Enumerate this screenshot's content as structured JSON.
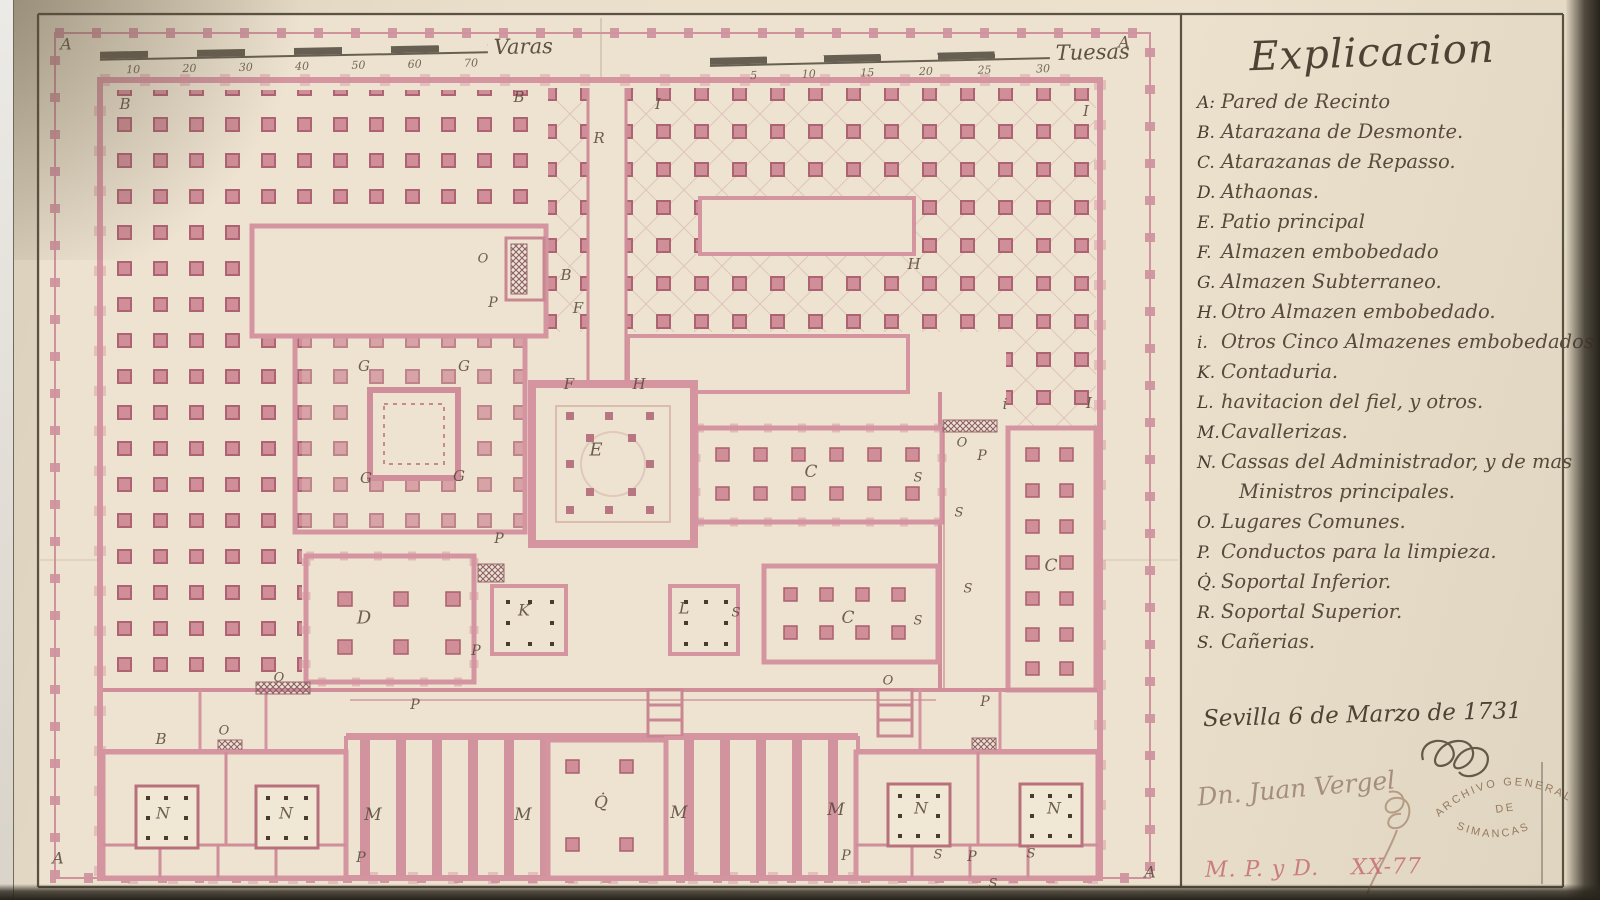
{
  "document": {
    "title": "Explicacion",
    "legend": [
      {
        "k": "A:",
        "t": "Pared de Recinto"
      },
      {
        "k": "B.",
        "t": "Atarazana de Desmonte."
      },
      {
        "k": "C.",
        "t": "Atarazanas de Repasso."
      },
      {
        "k": "D.",
        "t": "Athaonas."
      },
      {
        "k": "E.",
        "t": "Patio principal"
      },
      {
        "k": "F.",
        "t": "Almazen embobedado"
      },
      {
        "k": "G.",
        "t": "Almazen Subterraneo."
      },
      {
        "k": "H.",
        "t": "Otro Almazen embobedado."
      },
      {
        "k": "i.",
        "t": "Otros Cinco Almazenes embobedados"
      },
      {
        "k": "K.",
        "t": "Contaduria."
      },
      {
        "k": "L.",
        "t": "havitacion del fiel, y otros."
      },
      {
        "k": "M.",
        "t": "Cavallerizas."
      },
      {
        "k": "N.",
        "t": "Cassas del Administrador, y de mas",
        "t2": "Ministros principales."
      },
      {
        "k": "O.",
        "t": "Lugares Comunes."
      },
      {
        "k": "P.",
        "t": "Conductos para la limpieza."
      },
      {
        "k": "Q̇.",
        "t": "Soportal Inferior."
      },
      {
        "k": "R.",
        "t": "Soportal Superior."
      },
      {
        "k": "S.",
        "t": "Cañerias."
      }
    ],
    "date_line": "Sevilla 6 de Marzo de 1731",
    "signature": "Dn. Juan Vergel",
    "stamp": {
      "line1": "ARCHIVO GENERAL",
      "line2": "DE",
      "line3": "SIMANCAS"
    },
    "reference": "M. P. y D.    XX-77"
  },
  "scales": {
    "varas": {
      "label": "Varas",
      "ticks": [
        "10",
        "20",
        "30",
        "40",
        "50",
        "60",
        "70"
      ]
    },
    "tuesas": {
      "label": "Tuesas",
      "ticks": [
        "5",
        "10",
        "15",
        "20",
        "25",
        "30"
      ]
    }
  },
  "plan": {
    "labels": [
      {
        "t": "A",
        "x": 66,
        "y": 44,
        "s": 16
      },
      {
        "t": "A",
        "x": 1124,
        "y": 42,
        "s": 16
      },
      {
        "t": "A",
        "x": 58,
        "y": 858,
        "s": 16
      },
      {
        "t": "A",
        "x": 1150,
        "y": 872,
        "s": 16
      },
      {
        "t": "B",
        "x": 125,
        "y": 104
      },
      {
        "t": "B",
        "x": 519,
        "y": 97
      },
      {
        "t": "B",
        "x": 566,
        "y": 275
      },
      {
        "t": "B",
        "x": 161,
        "y": 739
      },
      {
        "t": "R",
        "x": 599,
        "y": 138
      },
      {
        "t": "I",
        "x": 658,
        "y": 104
      },
      {
        "t": "I",
        "x": 1086,
        "y": 111
      },
      {
        "t": "i",
        "x": 1005,
        "y": 404
      },
      {
        "t": "I",
        "x": 1089,
        "y": 403
      },
      {
        "t": "H",
        "x": 914,
        "y": 264
      },
      {
        "t": "H",
        "x": 639,
        "y": 384
      },
      {
        "t": "F",
        "x": 578,
        "y": 308
      },
      {
        "t": "F",
        "x": 569,
        "y": 384
      },
      {
        "t": "G",
        "x": 364,
        "y": 366
      },
      {
        "t": "G",
        "x": 464,
        "y": 366
      },
      {
        "t": "G",
        "x": 366,
        "y": 478
      },
      {
        "t": "G",
        "x": 459,
        "y": 476
      },
      {
        "t": "E",
        "x": 596,
        "y": 450,
        "s": 18
      },
      {
        "t": "C",
        "x": 811,
        "y": 472,
        "s": 17
      },
      {
        "t": "C",
        "x": 848,
        "y": 618,
        "s": 17
      },
      {
        "t": "C",
        "x": 1051,
        "y": 566,
        "s": 17
      },
      {
        "t": "K",
        "x": 524,
        "y": 610,
        "s": 16
      },
      {
        "t": "L",
        "x": 684,
        "y": 608,
        "s": 16
      },
      {
        "t": "D",
        "x": 364,
        "y": 618,
        "s": 18
      },
      {
        "t": "M",
        "x": 373,
        "y": 815,
        "s": 17
      },
      {
        "t": "M",
        "x": 523,
        "y": 815,
        "s": 17
      },
      {
        "t": "M",
        "x": 679,
        "y": 813,
        "s": 17
      },
      {
        "t": "M",
        "x": 836,
        "y": 810,
        "s": 17
      },
      {
        "t": "N",
        "x": 163,
        "y": 813,
        "s": 16
      },
      {
        "t": "N",
        "x": 286,
        "y": 813,
        "s": 16
      },
      {
        "t": "N",
        "x": 921,
        "y": 808,
        "s": 16
      },
      {
        "t": "N",
        "x": 1054,
        "y": 808,
        "s": 16
      },
      {
        "t": "Q̇",
        "x": 601,
        "y": 803,
        "s": 17
      },
      {
        "t": "O",
        "x": 483,
        "y": 259,
        "s": 13
      },
      {
        "t": "O",
        "x": 962,
        "y": 443,
        "s": 13
      },
      {
        "t": "O",
        "x": 888,
        "y": 681,
        "s": 13
      },
      {
        "t": "O",
        "x": 279,
        "y": 678,
        "s": 13
      },
      {
        "t": "O",
        "x": 224,
        "y": 731,
        "s": 13
      },
      {
        "t": "P",
        "x": 493,
        "y": 303,
        "s": 14
      },
      {
        "t": "P",
        "x": 476,
        "y": 651,
        "s": 14
      },
      {
        "t": "P",
        "x": 499,
        "y": 539,
        "s": 14
      },
      {
        "t": "P",
        "x": 415,
        "y": 705,
        "s": 14
      },
      {
        "t": "P",
        "x": 361,
        "y": 858,
        "s": 14
      },
      {
        "t": "P",
        "x": 846,
        "y": 856,
        "s": 14
      },
      {
        "t": "P",
        "x": 985,
        "y": 702,
        "s": 14
      },
      {
        "t": "P",
        "x": 972,
        "y": 857,
        "s": 14
      },
      {
        "t": "P",
        "x": 982,
        "y": 456,
        "s": 14
      },
      {
        "t": "S",
        "x": 918,
        "y": 478,
        "s": 13
      },
      {
        "t": "S",
        "x": 959,
        "y": 513,
        "s": 13
      },
      {
        "t": "S",
        "x": 968,
        "y": 589,
        "s": 13
      },
      {
        "t": "S",
        "x": 918,
        "y": 621,
        "s": 13
      },
      {
        "t": "S",
        "x": 736,
        "y": 613,
        "s": 13
      },
      {
        "t": "S",
        "x": 938,
        "y": 855,
        "s": 13
      },
      {
        "t": "S",
        "x": 1031,
        "y": 854,
        "s": 13
      },
      {
        "t": "S",
        "x": 993,
        "y": 884,
        "s": 13
      }
    ]
  },
  "colors": {
    "paper": "#ebe1cd",
    "wall_pink": "#d495a0",
    "pillar_pink": "#cf8e98",
    "ink": "#4e4234",
    "stamp_brown": "#8a6a4e",
    "reference_red": "#c4666d"
  }
}
